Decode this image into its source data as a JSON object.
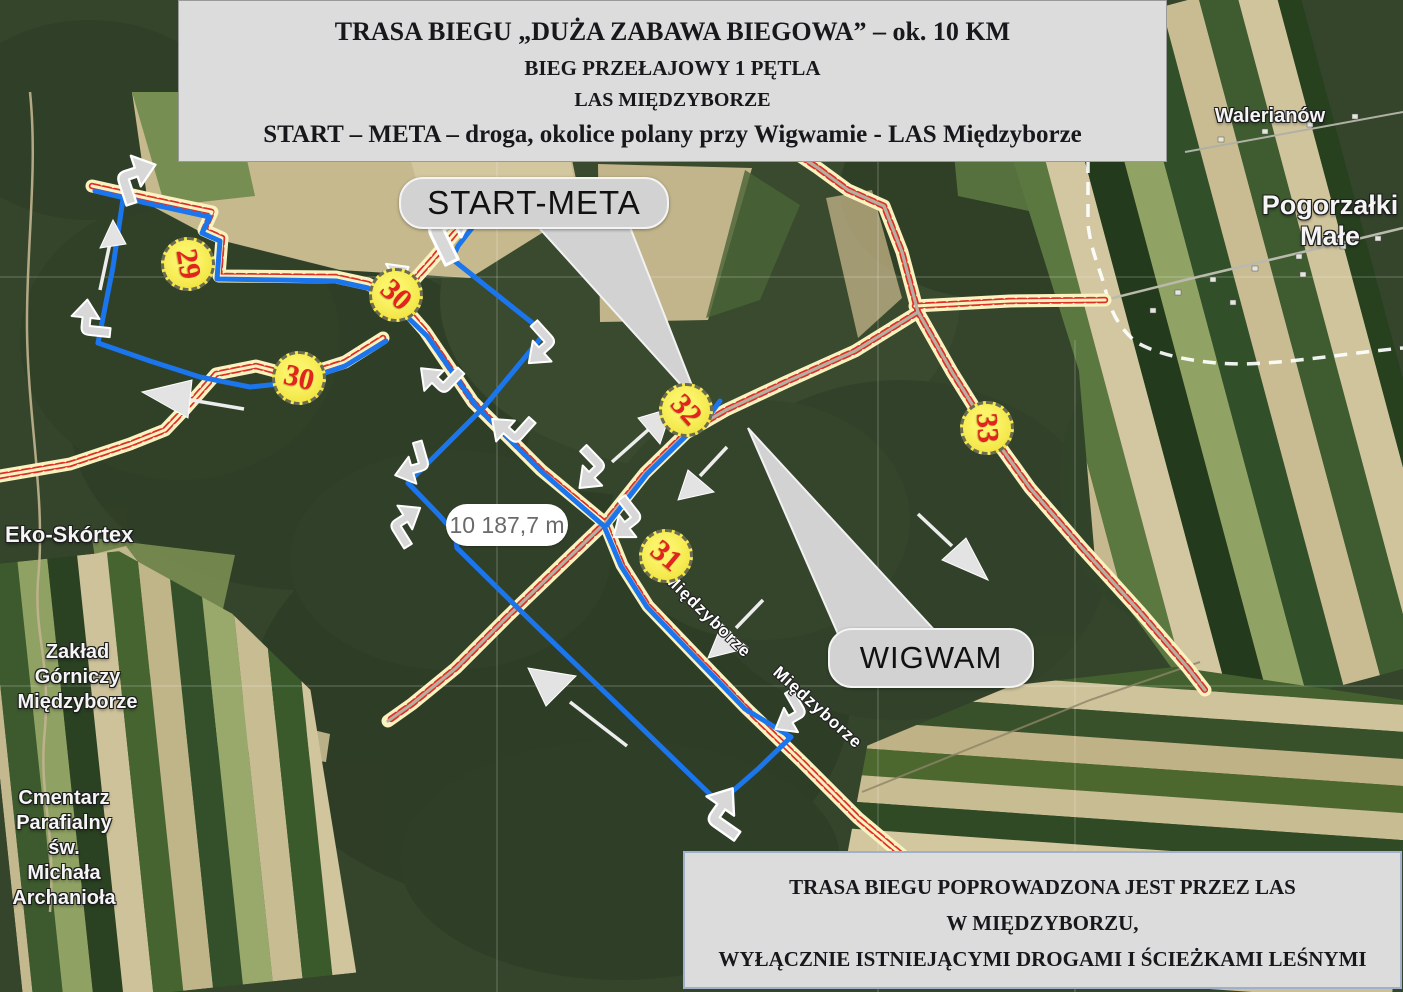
{
  "top_banner": {
    "line1": "TRASA BIEGU „DUŻA ZABAWA BIEGOWA” – ok. 10 KM",
    "line2": "BIEG PRZEŁAJOWY 1 PĘTLA",
    "line3": "LAS MIĘDZYBORZE",
    "line4": "START – META – droga, okolice polany przy Wigwamie  - LAS Międzyborze"
  },
  "bottom_banner": {
    "line1": "TRASA BIEGU POPROWADZONA JEST PRZEZ LAS",
    "line2": "W MIĘDZYBORZU,",
    "line3": "WYŁĄCZNIE ISTNIEJĄCYMI DROGAMI I ŚCIEŻKAMI LEŚNYMI"
  },
  "callouts": {
    "start_meta": "START-META",
    "wigwam": "WIGWAM"
  },
  "distance_label": "10 187,7 m",
  "checkpoints": [
    {
      "label": "29"
    },
    {
      "label": "30"
    },
    {
      "label": "30"
    },
    {
      "label": "31"
    },
    {
      "label": "32"
    },
    {
      "label": "33"
    }
  ],
  "road_labels": [
    {
      "text": "Międzyborze"
    },
    {
      "text": "Międzyborze"
    }
  ],
  "places": {
    "walerianow": "Walerianów",
    "pogorzalki_line1": "Pogorzałki",
    "pogorzalki_line2": "Małe",
    "eko_skortex": "Eko-Skórtex",
    "zaklad_line1": "Zakład",
    "zaklad_line2": "Górniczy",
    "zaklad_line3": "Międzyborze",
    "cmentarz_line1": "Cmentarz",
    "cmentarz_line2": "Parafialny św.",
    "cmentarz_line3": "Michała",
    "cmentarz_line4": "Archanioła"
  },
  "colors": {
    "route_blue": "#1b76ee",
    "road_fill": "#faf3c0",
    "road_stripe": "#dd2f28",
    "marker_fill": "#f7ee55",
    "marker_number": "#e2231e",
    "banner_bg": "#dcdcdc",
    "callout_bg": "#d2d2d2"
  }
}
